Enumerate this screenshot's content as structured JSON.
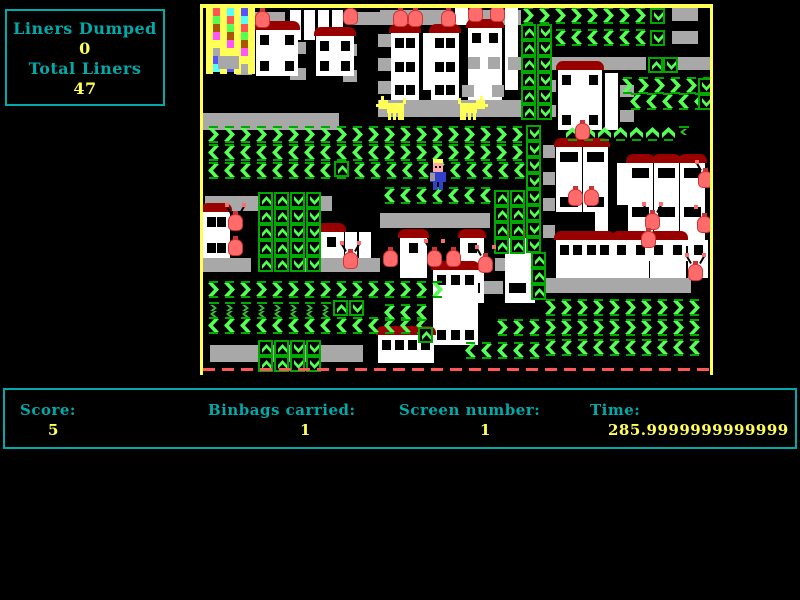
{
  "hud": {
    "liners_dumped_label": "Liners Dumped",
    "liners_dumped_value": "0",
    "total_liners_label": "Total Liners",
    "total_liners_value": "47"
  },
  "status": {
    "score_label": "Score:",
    "score_value": "5",
    "binbags_label": "Binbags carried:",
    "binbags_value": "1",
    "screen_label": "Screen number:",
    "screen_value": "1",
    "time_label": "Time:",
    "time_value": "285.9999999999999"
  },
  "colors": {
    "cyan": "#00AAAA",
    "yellow": "#FFFF55",
    "green": "#55FF55",
    "mgreen": "#2FBF2F",
    "dgreen": "#00A800",
    "gray": "#A8A8A8",
    "white": "#FFFFFF",
    "roof": "#990000",
    "bag": "#FF6B6B",
    "bagDark": "#CC3333",
    "blue": "#3340CC",
    "skin": "#FFAAAA",
    "arm": "#999999",
    "red": "#FF5555",
    "border": "#FFFF55",
    "dump": [
      "#FF5555",
      "#FF55FF",
      "#5555FF",
      "#55FF55",
      "#FFFF55",
      "#55FFFF",
      "#AA5500",
      "#AAAAAA"
    ]
  },
  "playfield": {
    "x": 200,
    "y": 4,
    "innerX": 203,
    "innerY": 8,
    "width": 513,
    "height": 371,
    "elements": [
      {
        "t": "platform",
        "x": 253,
        "y": 12,
        "w": 32,
        "h": 13
      },
      {
        "t": "platform",
        "x": 347,
        "y": 12,
        "w": 33,
        "h": 13
      },
      {
        "t": "platform",
        "x": 380,
        "y": 10,
        "w": 66,
        "h": 15
      },
      {
        "t": "platform",
        "x": 455,
        "y": 10,
        "w": 66,
        "h": 15
      },
      {
        "t": "platform",
        "x": 672,
        "y": 8,
        "w": 26,
        "h": 13
      },
      {
        "t": "platform",
        "x": 672,
        "y": 31,
        "w": 26,
        "h": 13
      },
      {
        "t": "platform",
        "x": 540,
        "y": 57,
        "w": 106,
        "h": 13
      },
      {
        "t": "platform",
        "x": 678,
        "y": 57,
        "w": 32,
        "h": 13
      },
      {
        "t": "platform",
        "x": 203,
        "y": 113,
        "w": 136,
        "h": 17
      },
      {
        "t": "platform",
        "x": 378,
        "y": 100,
        "w": 145,
        "h": 17
      },
      {
        "t": "platform",
        "x": 236,
        "y": 36,
        "w": 16,
        "h": 13
      },
      {
        "t": "platform",
        "x": 290,
        "y": 42,
        "w": 16,
        "h": 12
      },
      {
        "t": "platform",
        "x": 236,
        "y": 62,
        "w": 16,
        "h": 13
      },
      {
        "t": "platform",
        "x": 290,
        "y": 68,
        "w": 16,
        "h": 12
      },
      {
        "t": "platform",
        "x": 343,
        "y": 44,
        "w": 14,
        "h": 12
      },
      {
        "t": "platform",
        "x": 343,
        "y": 70,
        "w": 14,
        "h": 12
      },
      {
        "t": "platform",
        "x": 378,
        "y": 34,
        "w": 13,
        "h": 13
      },
      {
        "t": "platform",
        "x": 378,
        "y": 58,
        "w": 13,
        "h": 13
      },
      {
        "t": "platform",
        "x": 378,
        "y": 81,
        "w": 13,
        "h": 13
      },
      {
        "t": "platform",
        "x": 543,
        "y": 80,
        "w": 13,
        "h": 12
      },
      {
        "t": "platform",
        "x": 543,
        "y": 105,
        "w": 13,
        "h": 12
      },
      {
        "t": "platform",
        "x": 620,
        "y": 85,
        "w": 14,
        "h": 12
      },
      {
        "t": "platform",
        "x": 620,
        "y": 110,
        "w": 14,
        "h": 12
      },
      {
        "t": "platform",
        "x": 543,
        "y": 145,
        "w": 12,
        "h": 13
      },
      {
        "t": "platform",
        "x": 543,
        "y": 172,
        "w": 12,
        "h": 13
      },
      {
        "t": "platform",
        "x": 543,
        "y": 198,
        "w": 12,
        "h": 13
      },
      {
        "t": "platform",
        "x": 543,
        "y": 225,
        "w": 12,
        "h": 13
      },
      {
        "t": "platform",
        "x": 205,
        "y": 196,
        "w": 53,
        "h": 15
      },
      {
        "t": "platform",
        "x": 310,
        "y": 196,
        "w": 22,
        "h": 15
      },
      {
        "t": "platform",
        "x": 380,
        "y": 213,
        "w": 110,
        "h": 15
      },
      {
        "t": "platform",
        "x": 203,
        "y": 258,
        "w": 48,
        "h": 14
      },
      {
        "t": "platform",
        "x": 303,
        "y": 258,
        "w": 77,
        "h": 14
      },
      {
        "t": "platform",
        "x": 495,
        "y": 258,
        "w": 18,
        "h": 13
      },
      {
        "t": "platform",
        "x": 483,
        "y": 281,
        "w": 20,
        "h": 13
      },
      {
        "t": "platform",
        "x": 543,
        "y": 278,
        "w": 148,
        "h": 15
      },
      {
        "t": "platform",
        "x": 210,
        "y": 345,
        "w": 153,
        "h": 17
      },
      {
        "t": "platform",
        "x": 380,
        "y": 345,
        "w": 52,
        "h": 15
      },
      {
        "t": "whitebox",
        "x": 290,
        "y": 10,
        "w": 11,
        "h": 30
      },
      {
        "t": "whitebox",
        "x": 304,
        "y": 10,
        "w": 11,
        "h": 30
      },
      {
        "t": "whitebox",
        "x": 318,
        "y": 10,
        "w": 11,
        "h": 30
      },
      {
        "t": "whitebox",
        "x": 332,
        "y": 10,
        "w": 11,
        "h": 30
      },
      {
        "t": "whitebox",
        "x": 423,
        "y": 33,
        "w": 10,
        "h": 57
      },
      {
        "t": "whitebox",
        "x": 505,
        "y": 8,
        "w": 13,
        "h": 82
      },
      {
        "t": "whitebox",
        "x": 605,
        "y": 73,
        "w": 13,
        "h": 57
      },
      {
        "t": "whitebox",
        "x": 617,
        "y": 163,
        "w": 12,
        "h": 42
      },
      {
        "t": "whitebox",
        "x": 595,
        "y": 188,
        "w": 13,
        "h": 70
      },
      {
        "t": "whitebox",
        "x": 345,
        "y": 232,
        "w": 12,
        "h": 26
      },
      {
        "t": "whitebox",
        "x": 359,
        "y": 232,
        "w": 12,
        "h": 26
      },
      {
        "t": "whitebox",
        "x": 523,
        "y": 278,
        "w": 12,
        "h": 25
      },
      {
        "t": "whitebox",
        "x": 455,
        "y": 8,
        "w": 13,
        "h": 17
      },
      {
        "t": "house",
        "x": 256,
        "y": 30,
        "w": 42,
        "h": 46,
        "roof": 1,
        "wr": 2,
        "wc": 2
      },
      {
        "t": "house",
        "x": 316,
        "y": 36,
        "w": 38,
        "h": 40,
        "roof": 1,
        "wr": 2,
        "wc": 2
      },
      {
        "t": "house",
        "x": 391,
        "y": 33,
        "w": 28,
        "h": 67,
        "roof": 1,
        "wr": 3,
        "wc": 2
      },
      {
        "t": "house",
        "x": 431,
        "y": 33,
        "w": 28,
        "h": 67,
        "roof": 1,
        "wr": 3,
        "wc": 2
      },
      {
        "t": "house",
        "x": 468,
        "y": 28,
        "w": 34,
        "h": 72,
        "roof": 1,
        "wr": 1,
        "wc": 2
      },
      {
        "t": "house",
        "x": 558,
        "y": 70,
        "w": 44,
        "h": 60,
        "roof": 1,
        "wr": 2,
        "wc": 2
      },
      {
        "t": "house",
        "x": 556,
        "y": 147,
        "w": 26,
        "h": 65,
        "roof": 1,
        "wr": 2,
        "wc": 2
      },
      {
        "t": "house",
        "x": 583,
        "y": 147,
        "w": 25,
        "h": 65,
        "roof": 1,
        "wr": 2,
        "wc": 2
      },
      {
        "t": "house",
        "x": 628,
        "y": 163,
        "w": 25,
        "h": 98,
        "roof": 1,
        "wr": 3,
        "wc": 2
      },
      {
        "t": "house",
        "x": 654,
        "y": 163,
        "w": 25,
        "h": 98,
        "roof": 1,
        "wr": 3,
        "wc": 2
      },
      {
        "t": "house",
        "x": 680,
        "y": 163,
        "w": 25,
        "h": 98,
        "roof": 1,
        "wr": 3,
        "wc": 2
      },
      {
        "t": "house",
        "x": 556,
        "y": 240,
        "w": 57,
        "h": 38,
        "roof": 1,
        "wr": 1,
        "wc": 4
      },
      {
        "t": "house",
        "x": 613,
        "y": 240,
        "w": 36,
        "h": 38,
        "roof": 1,
        "wr": 1,
        "wc": 2
      },
      {
        "t": "house",
        "x": 650,
        "y": 240,
        "w": 36,
        "h": 38,
        "roof": 1,
        "wr": 1,
        "wc": 2
      },
      {
        "t": "house",
        "x": 688,
        "y": 240,
        "w": 20,
        "h": 38,
        "roof": 0,
        "wr": 1,
        "wc": 1
      },
      {
        "t": "house",
        "x": 203,
        "y": 212,
        "w": 27,
        "h": 46,
        "roof": 1,
        "wr": 2,
        "wc": 2
      },
      {
        "t": "house",
        "x": 318,
        "y": 232,
        "w": 26,
        "h": 26,
        "roof": 1,
        "wr": 1,
        "wc": 1
      },
      {
        "t": "house",
        "x": 400,
        "y": 238,
        "w": 27,
        "h": 40,
        "roof": 1,
        "wr": 1,
        "wc": 1
      },
      {
        "t": "house",
        "x": 460,
        "y": 238,
        "w": 24,
        "h": 40,
        "roof": 1,
        "wr": 1,
        "wc": 1
      },
      {
        "t": "house",
        "x": 505,
        "y": 238,
        "w": 26,
        "h": 40,
        "roof": 1,
        "wr": 1,
        "wc": 1
      },
      {
        "t": "house",
        "x": 460,
        "y": 278,
        "w": 24,
        "h": 25,
        "roof": 0,
        "wr": 1,
        "wc": 2
      },
      {
        "t": "house",
        "x": 505,
        "y": 278,
        "w": 25,
        "h": 25,
        "roof": 0,
        "wr": 1,
        "wc": 2
      },
      {
        "t": "house",
        "x": 433,
        "y": 270,
        "w": 45,
        "h": 75,
        "roof": 1,
        "wr": 2,
        "wc": 3
      },
      {
        "t": "house",
        "x": 378,
        "y": 335,
        "w": 56,
        "h": 28,
        "roof": 1,
        "wr": 1,
        "wc": 4
      },
      {
        "t": "platform",
        "x": 468,
        "y": 57,
        "w": 12,
        "h": 12
      },
      {
        "t": "platform",
        "x": 488,
        "y": 57,
        "w": 12,
        "h": 12
      },
      {
        "t": "platform",
        "x": 508,
        "y": 57,
        "w": 14,
        "h": 13
      },
      {
        "t": "platform",
        "x": 462,
        "y": 85,
        "w": 12,
        "h": 12
      },
      {
        "t": "platform",
        "x": 492,
        "y": 85,
        "w": 12,
        "h": 12
      },
      {
        "t": "chevrons",
        "x": 521,
        "y": 8,
        "n": 8,
        "d": "r"
      },
      {
        "t": "chevrons",
        "x": 553,
        "y": 30,
        "n": 6,
        "d": "l"
      },
      {
        "t": "chevrons",
        "x": 620,
        "y": 78,
        "n": 6,
        "d": "r"
      },
      {
        "t": "chevrons",
        "x": 628,
        "y": 94,
        "n": 5,
        "d": "l"
      },
      {
        "t": "chevrons",
        "x": 206,
        "y": 127,
        "n": 20,
        "d": "r"
      },
      {
        "t": "chevrons",
        "x": 206,
        "y": 145,
        "n": 11,
        "d": "l"
      },
      {
        "t": "chevrons",
        "x": 382,
        "y": 145,
        "n": 9,
        "d": "r"
      },
      {
        "t": "chevrons",
        "x": 206,
        "y": 163,
        "n": 9,
        "d": "l"
      },
      {
        "t": "chevrons",
        "x": 352,
        "y": 163,
        "n": 11,
        "d": "l"
      },
      {
        "t": "chevrons",
        "x": 382,
        "y": 188,
        "n": 7,
        "d": "l"
      },
      {
        "t": "chevrons",
        "x": 565,
        "y": 125,
        "n": 7,
        "d": "u"
      },
      {
        "t": "chevrons",
        "x": 206,
        "y": 282,
        "n": 15,
        "d": "r"
      },
      {
        "t": "chevrons",
        "x": 206,
        "y": 318,
        "n": 14,
        "d": "l"
      },
      {
        "t": "chevrons",
        "x": 382,
        "y": 305,
        "n": 3,
        "d": "l"
      },
      {
        "t": "chevrons",
        "x": 495,
        "y": 320,
        "n": 3,
        "d": "r"
      },
      {
        "t": "chevrons",
        "x": 463,
        "y": 343,
        "n": 5,
        "d": "l"
      },
      {
        "t": "chevrons",
        "x": 543,
        "y": 300,
        "n": 10,
        "d": "r"
      },
      {
        "t": "chevrons",
        "x": 543,
        "y": 320,
        "n": 10,
        "d": "r"
      },
      {
        "t": "chevrons",
        "x": 543,
        "y": 340,
        "n": 10,
        "d": "l"
      },
      {
        "t": "smallchevrons",
        "x": 206,
        "y": 302,
        "n": 8,
        "d1": "r",
        "d2": "l"
      },
      {
        "t": "smallchevrons",
        "x": 676,
        "y": 126,
        "n": 1,
        "d1": "l",
        "d2": ""
      },
      {
        "t": "vconveyor",
        "x": 521,
        "y": 24,
        "rows": 6,
        "d": "u"
      },
      {
        "t": "vconveyor",
        "x": 537,
        "y": 24,
        "rows": 6,
        "d": "d"
      },
      {
        "t": "vconveyor",
        "x": 648,
        "y": 57,
        "rows": 1,
        "d": "u"
      },
      {
        "t": "vconveyor",
        "x": 663,
        "y": 57,
        "rows": 1,
        "d": "d"
      },
      {
        "t": "vconveyor",
        "x": 650,
        "y": 8,
        "rows": 1,
        "d": "d"
      },
      {
        "t": "vconveyor",
        "x": 650,
        "y": 30,
        "rows": 1,
        "d": "d"
      },
      {
        "t": "vconveyor",
        "x": 698,
        "y": 78,
        "rows": 1,
        "d": "d"
      },
      {
        "t": "vconveyor",
        "x": 698,
        "y": 94,
        "rows": 1,
        "d": "d"
      },
      {
        "t": "vconveyor",
        "x": 258,
        "y": 192,
        "rows": 5,
        "d": "u"
      },
      {
        "t": "vconveyor",
        "x": 274,
        "y": 192,
        "rows": 5,
        "d": "u"
      },
      {
        "t": "vconveyor",
        "x": 290,
        "y": 192,
        "rows": 5,
        "d": "d"
      },
      {
        "t": "vconveyor",
        "x": 306,
        "y": 192,
        "rows": 5,
        "d": "d"
      },
      {
        "t": "vconveyor",
        "x": 334,
        "y": 161,
        "rows": 1,
        "d": "u"
      },
      {
        "t": "vconveyor",
        "x": 258,
        "y": 340,
        "rows": 2,
        "d": "u"
      },
      {
        "t": "vconveyor",
        "x": 274,
        "y": 340,
        "rows": 2,
        "d": "u"
      },
      {
        "t": "vconveyor",
        "x": 290,
        "y": 340,
        "rows": 2,
        "d": "d"
      },
      {
        "t": "vconveyor",
        "x": 306,
        "y": 340,
        "rows": 2,
        "d": "d"
      },
      {
        "t": "vconveyor",
        "x": 526,
        "y": 125,
        "rows": 8,
        "d": "d"
      },
      {
        "t": "vconveyor",
        "x": 494,
        "y": 190,
        "rows": 4,
        "d": "u"
      },
      {
        "t": "vconveyor",
        "x": 510,
        "y": 190,
        "rows": 4,
        "d": "u"
      },
      {
        "t": "vconveyor",
        "x": 531,
        "y": 252,
        "rows": 3,
        "d": "u"
      },
      {
        "t": "vconveyor",
        "x": 333,
        "y": 300,
        "rows": 1,
        "d": "u"
      },
      {
        "t": "vconveyor",
        "x": 349,
        "y": 300,
        "rows": 1,
        "d": "d"
      },
      {
        "t": "vconveyor",
        "x": 418,
        "y": 327,
        "rows": 1,
        "d": "u"
      },
      {
        "t": "dump",
        "x": 206,
        "y": 8
      },
      {
        "t": "redline",
        "x": 203,
        "y": 368,
        "w": 508
      },
      {
        "t": "binbag",
        "x": 255,
        "y": 8,
        "ant": 0
      },
      {
        "t": "binbag",
        "x": 343,
        "y": 5,
        "ant": 1
      },
      {
        "t": "binbag",
        "x": 393,
        "y": 7,
        "ant": 0
      },
      {
        "t": "binbag",
        "x": 408,
        "y": 7,
        "ant": 0
      },
      {
        "t": "binbag",
        "x": 441,
        "y": 7,
        "ant": 0
      },
      {
        "t": "binbag",
        "x": 468,
        "y": 2,
        "ant": 1
      },
      {
        "t": "binbag",
        "x": 490,
        "y": 2,
        "ant": 1
      },
      {
        "t": "binbag",
        "x": 575,
        "y": 120,
        "ant": 0
      },
      {
        "t": "binbag",
        "x": 568,
        "y": 186,
        "ant": 0
      },
      {
        "t": "binbag",
        "x": 584,
        "y": 186,
        "ant": 0
      },
      {
        "t": "binbag",
        "x": 645,
        "y": 210,
        "ant": 1
      },
      {
        "t": "binbag",
        "x": 698,
        "y": 168,
        "ant": 1
      },
      {
        "t": "binbag",
        "x": 697,
        "y": 213,
        "ant": 1
      },
      {
        "t": "binbag",
        "x": 641,
        "y": 228,
        "ant": 0
      },
      {
        "t": "binbag",
        "x": 688,
        "y": 261,
        "ant": 1
      },
      {
        "t": "binbag",
        "x": 228,
        "y": 211,
        "ant": 1
      },
      {
        "t": "binbag",
        "x": 228,
        "y": 236,
        "ant": 0
      },
      {
        "t": "binbag",
        "x": 343,
        "y": 249,
        "ant": 1
      },
      {
        "t": "binbag",
        "x": 383,
        "y": 247,
        "ant": 0
      },
      {
        "t": "binbag",
        "x": 427,
        "y": 247,
        "ant": 1
      },
      {
        "t": "binbag",
        "x": 446,
        "y": 247,
        "ant": 0
      },
      {
        "t": "binbag",
        "x": 478,
        "y": 253,
        "ant": 1
      },
      {
        "t": "dog",
        "x": 376,
        "y": 96,
        "face": "left"
      },
      {
        "t": "dog",
        "x": 458,
        "y": 96,
        "face": "right"
      },
      {
        "t": "player",
        "x": 430,
        "y": 159
      }
    ]
  }
}
